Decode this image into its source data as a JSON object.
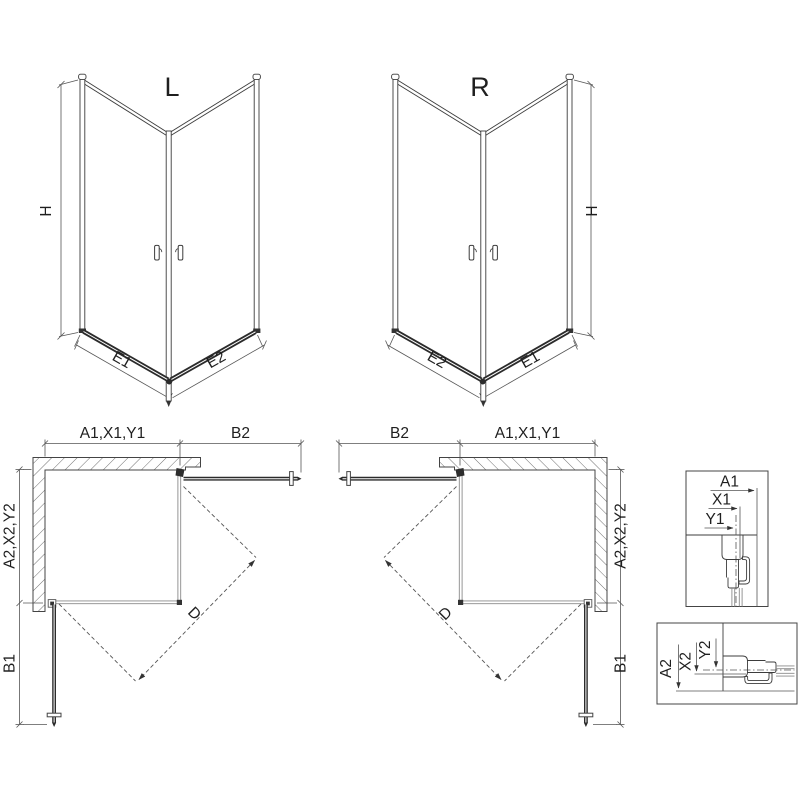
{
  "drawing": {
    "iso_left": {
      "label": "L",
      "dim_height": "H",
      "dim_bottom_left": "E1",
      "dim_bottom_right": "E2"
    },
    "iso_right": {
      "label": "R",
      "dim_height": "H",
      "dim_bottom_left": "E2",
      "dim_bottom_right": "E1"
    },
    "plan_left": {
      "dim_top_left": "A1,X1,Y1",
      "dim_top_right": "B2",
      "dim_side_top": "A2,X2,Y2",
      "dim_side_bottom": "B1",
      "dim_diagonal": "D"
    },
    "plan_right": {
      "dim_top_left": "B2",
      "dim_top_right": "A1,X1,Y1",
      "dim_side_top": "A2,X2,Y2",
      "dim_side_bottom": "B1",
      "dim_diagonal": "D"
    },
    "detail_top": {
      "dim1": "A1",
      "dim2": "X1",
      "dim3": "Y1"
    },
    "detail_bottom": {
      "dim1": "A2",
      "dim2": "X2",
      "dim3": "Y2"
    },
    "colors": {
      "line": "#3c3c3c",
      "dark": "#2b2b2b",
      "glass": "#8a8a8a",
      "background": "#ffffff"
    }
  }
}
